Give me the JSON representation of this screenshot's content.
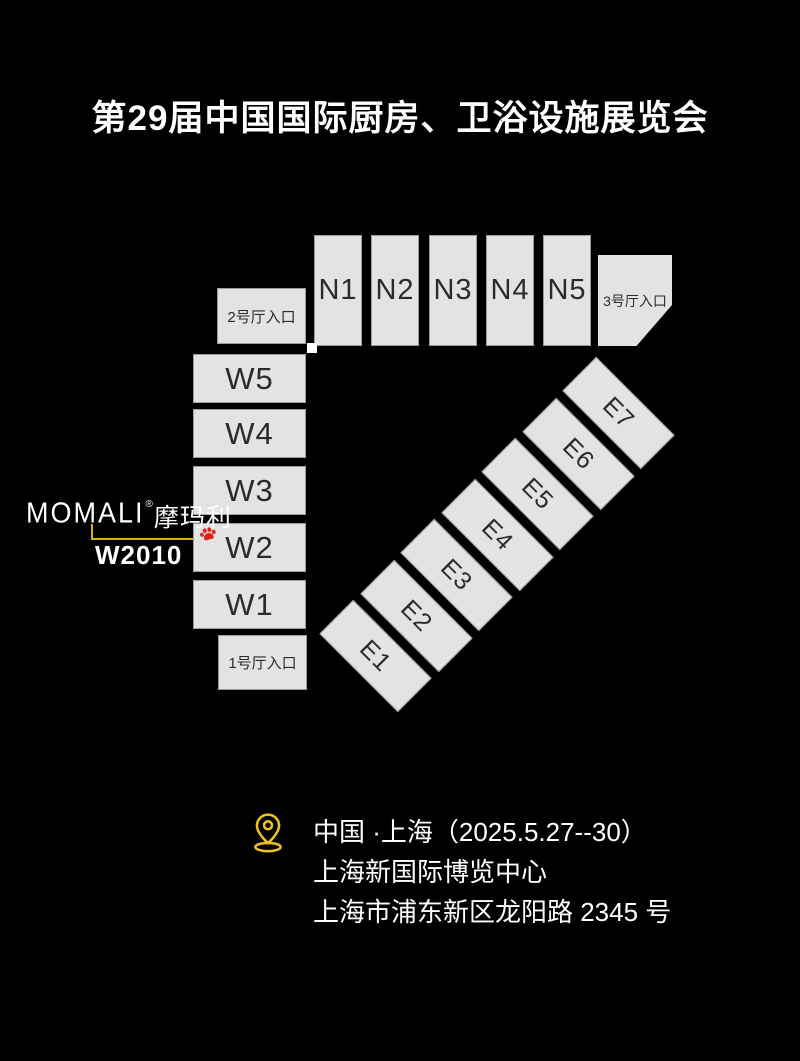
{
  "title": "第29届中国国际厨房、卫浴设施展览会",
  "map": {
    "north_halls": [
      {
        "label": "N1"
      },
      {
        "label": "N2"
      },
      {
        "label": "N3"
      },
      {
        "label": "N4"
      },
      {
        "label": "N5"
      }
    ],
    "west_halls": [
      {
        "label": "W5"
      },
      {
        "label": "W4"
      },
      {
        "label": "W3"
      },
      {
        "label": "W2"
      },
      {
        "label": "W1"
      }
    ],
    "east_halls": [
      {
        "label": "E1"
      },
      {
        "label": "E2"
      },
      {
        "label": "E3"
      },
      {
        "label": "E4"
      },
      {
        "label": "E5"
      },
      {
        "label": "E6"
      },
      {
        "label": "E7"
      }
    ],
    "entrances": {
      "hall1": "1号厅入口",
      "hall2": "2号厅入口",
      "hall3": "3号厅入口"
    },
    "colors": {
      "hall_fill": "#e3e3e4",
      "hall_border": "#9c9c9c",
      "hall_text": "#2b2b2b",
      "background": "#000000"
    }
  },
  "exhibitor": {
    "brand_latin": "MOMALI",
    "registered_mark": "®",
    "brand_cjk": "摩玛利",
    "booth": "W2010",
    "accent_color": "#d8b010",
    "paw_color": "#e0211b"
  },
  "venue": {
    "line1": "中国 ·上海（2025.5.27--30）",
    "line2": "上海新国际博览中心",
    "line3": "上海市浦东新区龙阳路 2345 号",
    "pin_color": "#eec31e"
  }
}
